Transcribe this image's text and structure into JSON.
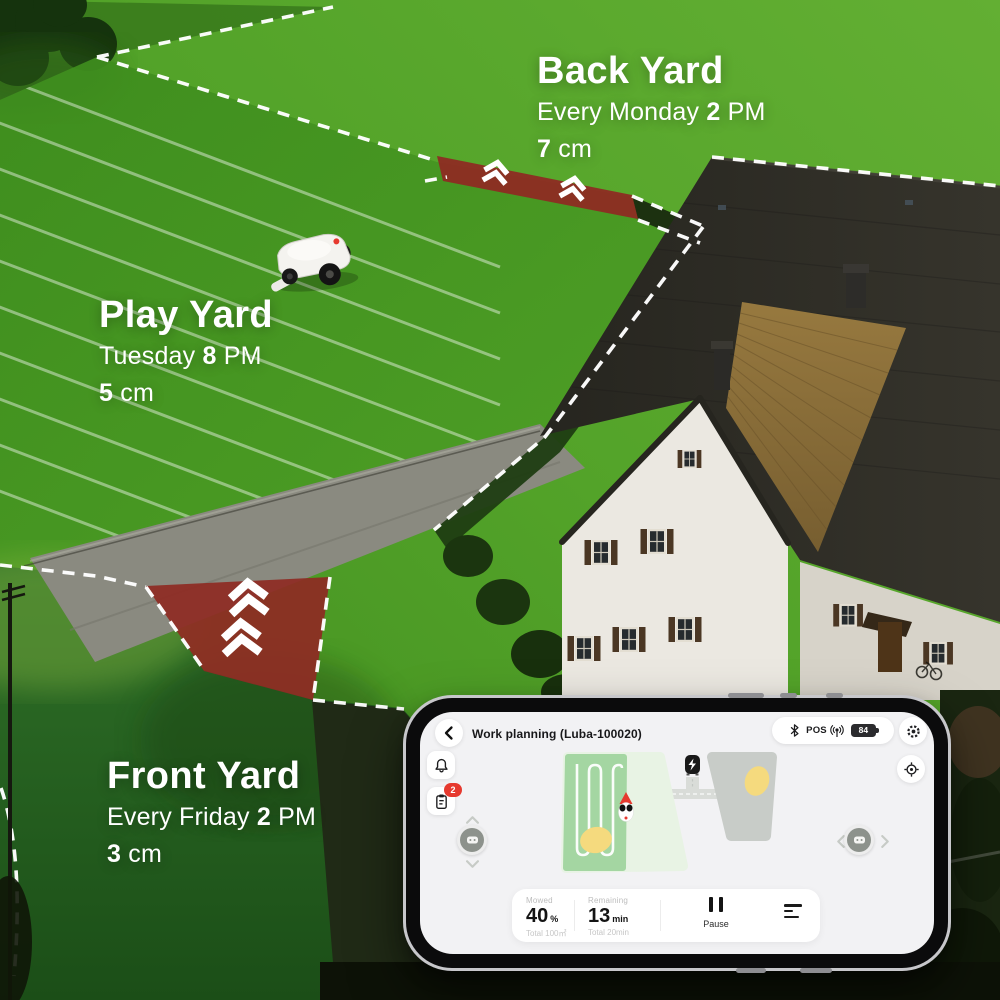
{
  "overlays": {
    "zones": [
      {
        "name": "Back Yard",
        "schedule_pre": "Every Monday",
        "schedule_num": "2",
        "schedule_suf": "PM",
        "height_num": "7",
        "height_unit": "cm"
      },
      {
        "name": "Play Yard",
        "schedule_pre": "Tuesday",
        "schedule_num": "8",
        "schedule_suf": "PM",
        "height_num": "5",
        "height_unit": "cm"
      },
      {
        "name": "Front Yard",
        "schedule_pre": "Every Friday",
        "schedule_num": "2",
        "schedule_suf": "PM",
        "height_num": "3",
        "height_unit": "cm"
      }
    ]
  },
  "phone": {
    "header": {
      "title": "Work planning (Luba-100020)",
      "pos_label": "POS",
      "battery_percent": "84"
    },
    "badges": {
      "tasks_count": "2"
    },
    "stats": {
      "mowed_label": "Mowed",
      "mowed_value": "40",
      "mowed_unit": "%",
      "mowed_total": "Total 100㎡",
      "remaining_label": "Remaining",
      "remaining_value": "13",
      "remaining_unit": "min",
      "remaining_total": "Total 20min",
      "pause_label": "Pause"
    }
  },
  "icons": {
    "back": "chevron-left",
    "settings": "gear",
    "notifications": "bell",
    "tasks": "clipboard",
    "locate": "crosshair-target",
    "bluetooth": "bluetooth",
    "rtk": "antenna-signal",
    "battery": "battery",
    "pause": "pause-bars",
    "task_menu": "list",
    "passage_direction": "double-chevron-up",
    "robot": "mower",
    "dock": "charging-station"
  },
  "colors": {
    "accent_red": "#e6392e",
    "passage_red": "#8e2b23",
    "mowed_green": "#a4d6a2",
    "unmowed_green": "#e8f3e4",
    "zone_gray": "#c8ccc8",
    "obstacle_yellow": "#f5da7e",
    "screen_bg": "#f2f2f4"
  }
}
